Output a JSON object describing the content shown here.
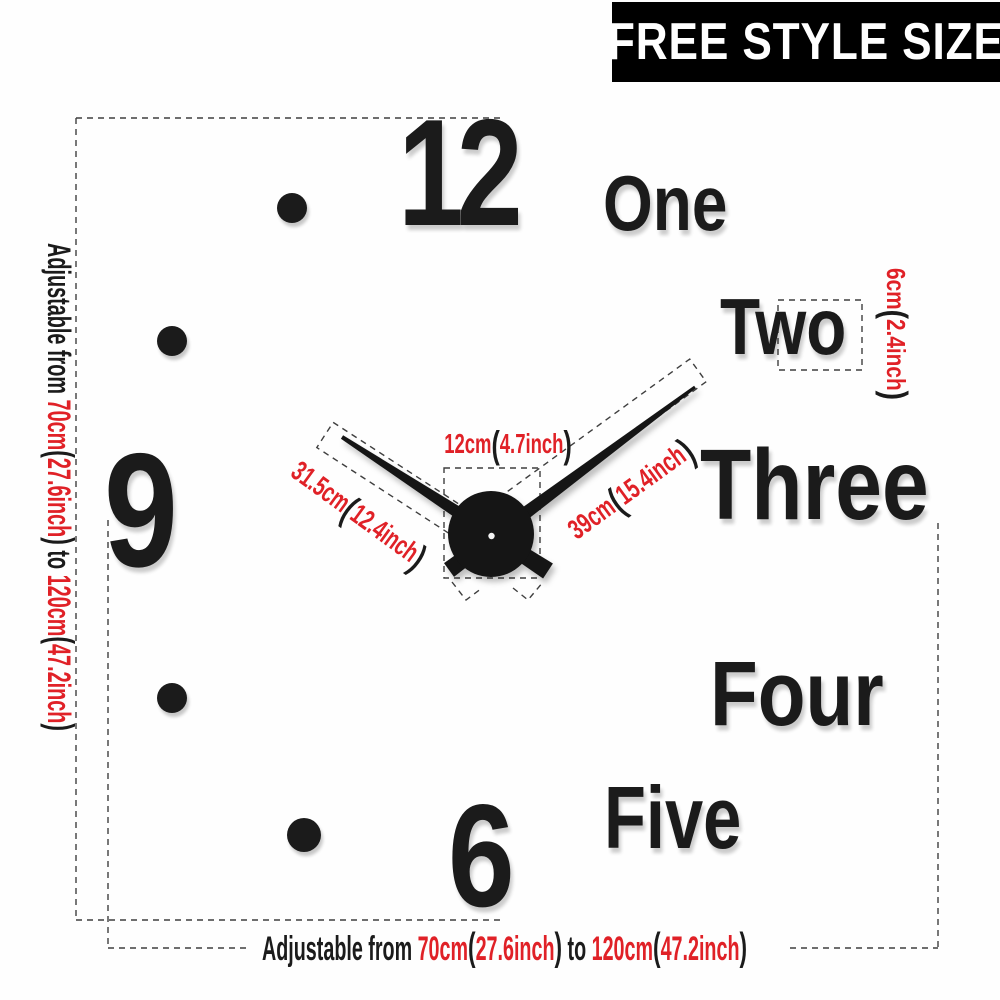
{
  "colors": {
    "red": "#e02127",
    "black": "#1b1b1b",
    "banner_bg": "#000000",
    "banner_text": "#ffffff"
  },
  "banner": {
    "label": "FREE STYLE SIZE"
  },
  "clock": {
    "numerals": {
      "twelve": "12",
      "nine": "9",
      "six": "6"
    },
    "words": {
      "one": "One",
      "two": "Two",
      "three": "Three",
      "four": "Four",
      "five": "Five"
    }
  },
  "measurements": {
    "center_device_width": {
      "segments": [
        {
          "text": "12cm",
          "color": "red"
        },
        {
          "text": "(",
          "color": "black",
          "paren": true
        },
        {
          "text": "4.7inch",
          "color": "red"
        },
        {
          "text": ")",
          "color": "black",
          "paren": true
        }
      ]
    },
    "hour_hand_length": {
      "segments": [
        {
          "text": "31.5cm",
          "color": "red"
        },
        {
          "text": "(",
          "color": "black",
          "paren": true
        },
        {
          "text": "12.4inch",
          "color": "red"
        },
        {
          "text": ")",
          "color": "black",
          "paren": true
        }
      ]
    },
    "minute_hand_length": {
      "segments": [
        {
          "text": "39cm",
          "color": "red"
        },
        {
          "text": "(",
          "color": "black",
          "paren": true
        },
        {
          "text": "15.4inch",
          "color": "red"
        },
        {
          "text": ")",
          "color": "black",
          "paren": true
        }
      ]
    },
    "word_height": {
      "segments": [
        {
          "text": "6cm",
          "color": "red"
        },
        {
          "text": "(",
          "color": "black",
          "paren": true
        },
        {
          "text": "2.4inch",
          "color": "red"
        },
        {
          "text": ")",
          "color": "black",
          "paren": true
        }
      ]
    },
    "vertical_range": {
      "segments": [
        {
          "text": "Adjustable from ",
          "color": "black"
        },
        {
          "text": "70cm",
          "color": "red"
        },
        {
          "text": "(",
          "color": "black",
          "paren": true
        },
        {
          "text": "27.6inch",
          "color": "red"
        },
        {
          "text": ")",
          "color": "black",
          "paren": true
        },
        {
          "text": " to ",
          "color": "black"
        },
        {
          "text": "120cm",
          "color": "red"
        },
        {
          "text": "(",
          "color": "black",
          "paren": true
        },
        {
          "text": "47.2inch",
          "color": "red"
        },
        {
          "text": ")",
          "color": "black",
          "paren": true
        }
      ]
    },
    "horizontal_range": {
      "segments": [
        {
          "text": "Adjustable from ",
          "color": "black"
        },
        {
          "text": "70cm",
          "color": "red"
        },
        {
          "text": "(",
          "color": "black",
          "paren": true
        },
        {
          "text": "27.6inch",
          "color": "red"
        },
        {
          "text": ")",
          "color": "black",
          "paren": true
        },
        {
          "text": " to ",
          "color": "black"
        },
        {
          "text": "120cm",
          "color": "red"
        },
        {
          "text": "(",
          "color": "black",
          "paren": true
        },
        {
          "text": "47.2inch",
          "color": "red"
        },
        {
          "text": ")",
          "color": "black",
          "paren": true
        }
      ]
    }
  }
}
